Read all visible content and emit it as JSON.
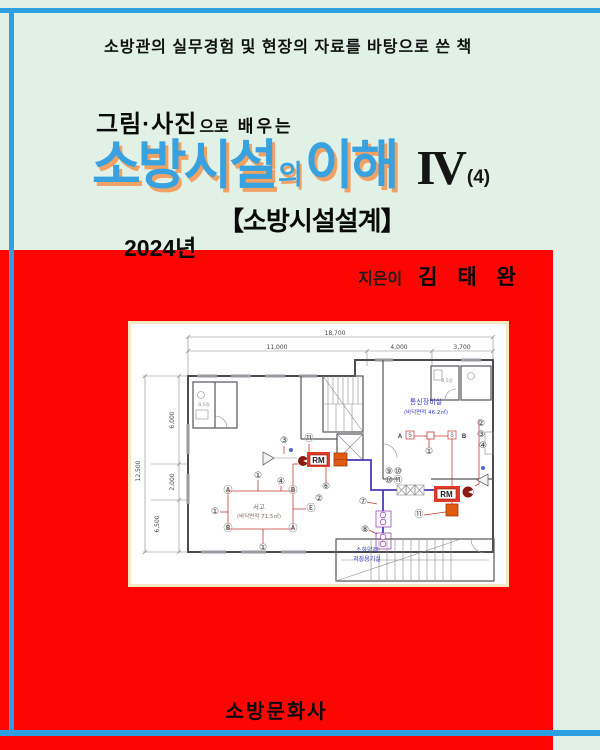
{
  "colors": {
    "background_mint": "#E2F1E5",
    "cover_red": "#FB0602",
    "border_blue": "#2D9FE3",
    "title_blue": "#38A1DF",
    "title_shadow_orange": "#F0A164"
  },
  "header": {
    "tagline": "소방관의 실무경험 및 현장의 자료를 바탕으로 쓴 책"
  },
  "subtitle": {
    "lead": "그림·사진",
    "particle": "으로",
    "tail": "배우는"
  },
  "title": {
    "part1": "소방시설",
    "particle": "의",
    "part2": "이해",
    "volume": "IV",
    "volume_note": "(4)"
  },
  "edition": "【소방시설설계】",
  "year": "2024년",
  "author": {
    "label": "지은이",
    "name": "김 태 완"
  },
  "publisher": "소방문화사",
  "floorplan": {
    "dims": {
      "total_width": "18,700",
      "w_left": "11,000",
      "w_mid": "4,000",
      "w_right": "3,700",
      "h_total": "12,500",
      "h_upper": "6,000",
      "h_mid": "2,000",
      "h_lower": "6,500"
    },
    "rooms": {
      "comm_name": "통신장비실",
      "comm_area": "(바닥면적 46.2㎡)",
      "archive_name": "서고",
      "archive_area": "(바닥면적 71.5㎡)",
      "agent_line1": "소화약제",
      "agent_line2": "저장용기실",
      "toilet_left": "B,S실",
      "toilet_right": "B,S실"
    },
    "equipment": {
      "rm1": "RM",
      "rm2": "RM",
      "a": "A",
      "b": "B",
      "s1": "S",
      "s2": "S"
    },
    "symbols": [
      {
        "t": "①",
        "x": 127,
        "y": 152
      },
      {
        "t": "Ⓐ",
        "x": 97,
        "y": 167
      },
      {
        "t": "④",
        "x": 150,
        "y": 158
      },
      {
        "t": "Ⓑ",
        "x": 162,
        "y": 167
      },
      {
        "t": "Ⓑ",
        "x": 97,
        "y": 205
      },
      {
        "t": "Ⓐ",
        "x": 162,
        "y": 205
      },
      {
        "t": "①",
        "x": 84,
        "y": 188
      },
      {
        "t": "Ⓔ",
        "x": 180,
        "y": 185
      },
      {
        "t": "②",
        "x": 188,
        "y": 175
      },
      {
        "t": "①",
        "x": 132,
        "y": 224
      },
      {
        "t": "⑥",
        "x": 195,
        "y": 163
      },
      {
        "t": "③",
        "x": 153,
        "y": 117
      },
      {
        "t": "⑪",
        "x": 178,
        "y": 115
      },
      {
        "t": "⑦",
        "x": 232,
        "y": 178
      },
      {
        "t": "⑧",
        "x": 234,
        "y": 206
      },
      {
        "t": "⑨",
        "x": 258,
        "y": 148
      },
      {
        "t": "⑩",
        "x": 267,
        "y": 148
      },
      {
        "t": "⑩",
        "x": 258,
        "y": 157
      },
      {
        "t": "⑪",
        "x": 267,
        "y": 157
      },
      {
        "t": "①",
        "x": 298,
        "y": 128
      },
      {
        "t": "②",
        "x": 350,
        "y": 100
      },
      {
        "t": "③",
        "x": 350,
        "y": 111
      },
      {
        "t": "④",
        "x": 352,
        "y": 122
      },
      {
        "t": "⑪",
        "x": 288,
        "y": 191
      }
    ]
  }
}
